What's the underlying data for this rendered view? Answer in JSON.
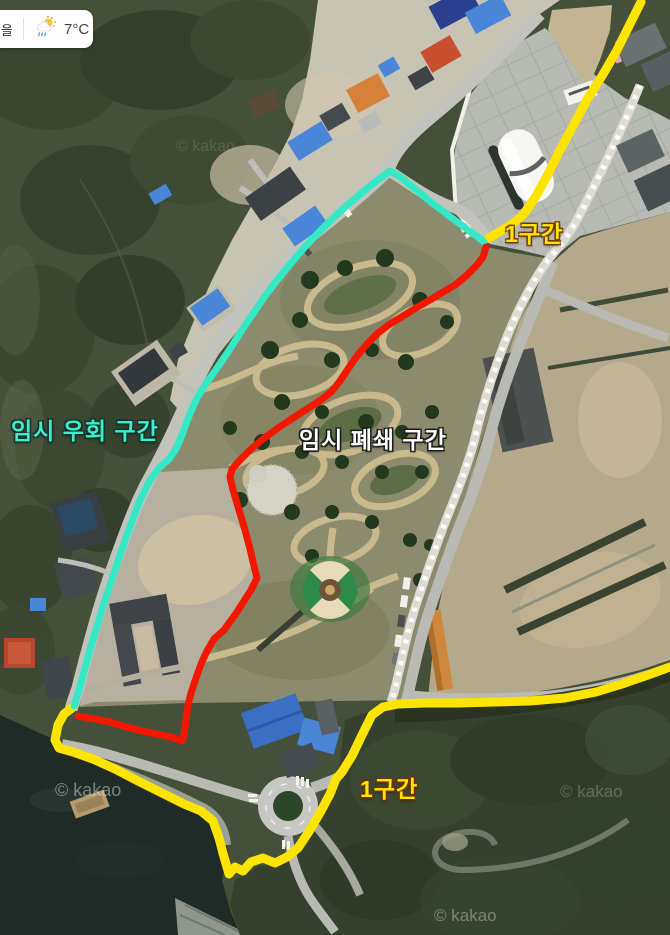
{
  "weather_widget": {
    "partial_location_text": "을",
    "temperature": "7°C",
    "icon": "sun-rain-cloud-icon"
  },
  "map": {
    "type": "satellite-aerial-view",
    "provider_watermark": "© kakao",
    "watermarks": [
      {
        "text": "© kakao",
        "x": 176,
        "y": 138,
        "opacity": 0.14,
        "size": 16
      },
      {
        "text": "© kakao",
        "x": 55,
        "y": 780,
        "opacity": 0.45,
        "size": 18
      },
      {
        "text": "© kakao",
        "x": 560,
        "y": 782,
        "opacity": 0.25,
        "size": 17
      },
      {
        "text": "© kakao",
        "x": 434,
        "y": 906,
        "opacity": 0.38,
        "size": 17
      }
    ],
    "routes": [
      {
        "id": "section1-north",
        "label": "1구간",
        "color": "#FFE400",
        "label_color": "#FFE400",
        "label_outline": "rgba(110,50,0,0.85)",
        "label_x": 505,
        "label_y": 215,
        "width": 9,
        "points": [
          [
            641,
            2
          ],
          [
            630,
            24
          ],
          [
            616,
            52
          ],
          [
            602,
            76
          ],
          [
            588,
            98
          ],
          [
            573,
            126
          ],
          [
            559,
            152
          ],
          [
            547,
            176
          ],
          [
            536,
            196
          ],
          [
            524,
            214
          ],
          [
            511,
            225
          ],
          [
            499,
            232
          ],
          [
            489,
            238
          ]
        ]
      },
      {
        "id": "section1-south",
        "label": "1구간",
        "color": "#FFE400",
        "label_color": "#FFE400",
        "label_outline": "rgba(110,50,0,0.85)",
        "label_x": 360,
        "label_y": 770,
        "width": 9,
        "points": [
          [
            670,
            667
          ],
          [
            648,
            675
          ],
          [
            622,
            684
          ],
          [
            596,
            692
          ],
          [
            565,
            698
          ],
          [
            530,
            701
          ],
          [
            495,
            702
          ],
          [
            458,
            703
          ],
          [
            425,
            703
          ],
          [
            398,
            704
          ],
          [
            383,
            707
          ],
          [
            372,
            715
          ],
          [
            363,
            733
          ],
          [
            352,
            756
          ],
          [
            342,
            772
          ],
          [
            336,
            779
          ],
          [
            330,
            794
          ],
          [
            321,
            811
          ],
          [
            310,
            830
          ],
          [
            298,
            848
          ],
          [
            287,
            857
          ],
          [
            275,
            863
          ],
          [
            263,
            858
          ],
          [
            251,
            862
          ],
          [
            243,
            871
          ],
          [
            235,
            867
          ],
          [
            229,
            874
          ],
          [
            224,
            857
          ],
          [
            219,
            838
          ],
          [
            213,
            821
          ],
          [
            201,
            811
          ],
          [
            184,
            804
          ],
          [
            162,
            793
          ],
          [
            138,
            781
          ],
          [
            115,
            769
          ],
          [
            93,
            759
          ],
          [
            73,
            752
          ],
          [
            59,
            748
          ],
          [
            55,
            740
          ],
          [
            58,
            725
          ],
          [
            64,
            714
          ],
          [
            72,
            708
          ]
        ]
      },
      {
        "id": "temporary-detour",
        "label": "임시 우회 구간",
        "color": "#35E9C6",
        "label_color": "#3DEec8",
        "label_outline": "rgba(20,50,45,0.9)",
        "label_x": 11,
        "label_y": 412,
        "width": 7,
        "points": [
          [
            74,
            706
          ],
          [
            79,
            690
          ],
          [
            85,
            668
          ],
          [
            91,
            646
          ],
          [
            97,
            626
          ],
          [
            103,
            606
          ],
          [
            110,
            585
          ],
          [
            117,
            564
          ],
          [
            124,
            543
          ],
          [
            132,
            521
          ],
          [
            140,
            500
          ],
          [
            149,
            482
          ],
          [
            159,
            468
          ],
          [
            169,
            459
          ],
          [
            176,
            449
          ],
          [
            182,
            435
          ],
          [
            189,
            416
          ],
          [
            197,
            398
          ],
          [
            207,
            382
          ],
          [
            217,
            368
          ],
          [
            228,
            352
          ],
          [
            240,
            333
          ],
          [
            252,
            315
          ],
          [
            265,
            296
          ],
          [
            278,
            279
          ],
          [
            291,
            263
          ],
          [
            304,
            248
          ],
          [
            317,
            234
          ],
          [
            330,
            221
          ],
          [
            344,
            208
          ],
          [
            358,
            196
          ],
          [
            371,
            185
          ],
          [
            382,
            177
          ],
          [
            390,
            171
          ],
          [
            399,
            176
          ],
          [
            409,
            184
          ],
          [
            420,
            193
          ],
          [
            432,
            203
          ],
          [
            444,
            212
          ],
          [
            456,
            221
          ],
          [
            468,
            230
          ],
          [
            478,
            237
          ],
          [
            484,
            242
          ]
        ]
      },
      {
        "id": "temporary-closure",
        "label": "임시 폐쇄 구간",
        "color": "#F21800",
        "label_color": "#FFFFFF",
        "label_outline": "rgba(25,25,25,0.9)",
        "label_x": 299,
        "label_y": 421,
        "width": 7,
        "points": [
          [
            486,
            247
          ],
          [
            483,
            257
          ],
          [
            476,
            266
          ],
          [
            466,
            276
          ],
          [
            455,
            285
          ],
          [
            443,
            292
          ],
          [
            430,
            300
          ],
          [
            416,
            308
          ],
          [
            403,
            316
          ],
          [
            390,
            324
          ],
          [
            378,
            333
          ],
          [
            367,
            344
          ],
          [
            357,
            356
          ],
          [
            348,
            369
          ],
          [
            340,
            381
          ],
          [
            332,
            391
          ],
          [
            321,
            400
          ],
          [
            307,
            409
          ],
          [
            293,
            418
          ],
          [
            278,
            428
          ],
          [
            263,
            439
          ],
          [
            250,
            450
          ],
          [
            240,
            460
          ],
          [
            232,
            469
          ],
          [
            230,
            477
          ],
          [
            233,
            490
          ],
          [
            239,
            510
          ],
          [
            245,
            530
          ],
          [
            250,
            549
          ],
          [
            254,
            566
          ],
          [
            257,
            578
          ],
          [
            251,
            590
          ],
          [
            244,
            601
          ],
          [
            235,
            615
          ],
          [
            224,
            630
          ],
          [
            214,
            639
          ],
          [
            207,
            651
          ],
          [
            201,
            664
          ],
          [
            196,
            678
          ],
          [
            191,
            693
          ],
          [
            188,
            705
          ],
          [
            186,
            720
          ],
          [
            184,
            734
          ],
          [
            182,
            741
          ],
          [
            171,
            737
          ],
          [
            157,
            734
          ],
          [
            142,
            731
          ],
          [
            126,
            727
          ],
          [
            110,
            722
          ],
          [
            95,
            719
          ],
          [
            84,
            717
          ],
          [
            78,
            716
          ]
        ]
      }
    ]
  }
}
